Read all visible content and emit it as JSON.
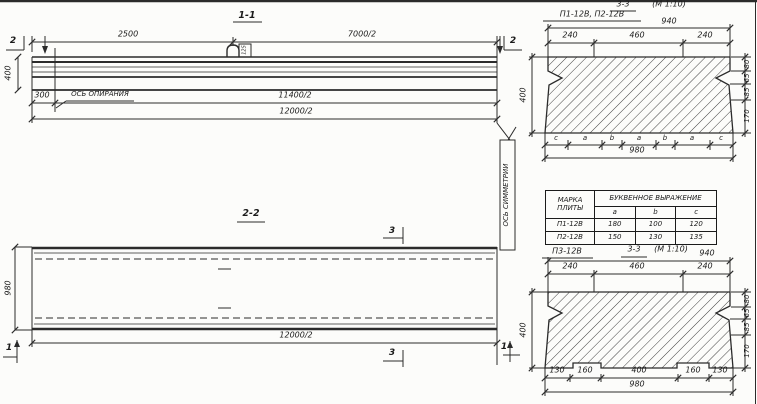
{
  "section11": {
    "title": "1-1",
    "dim_2500": "2500",
    "dim_7000": "7000/2",
    "cut_left": "2",
    "cut_right": "2",
    "dim_height": "400",
    "dim_300": "300",
    "support_axis_label": "ОСЬ ОПИРАНИЯ",
    "dim_11400": "11400/2",
    "dim_12000": "12000/2",
    "loop_mark": "125"
  },
  "section22": {
    "title": "2-2",
    "cut_3_top": "3",
    "cut_3_bottom": "3",
    "cut_1_left": "1",
    "cut_1_right": "1",
    "dim_width": "980",
    "dim_length": "12000/2",
    "symmetry_axis_label": "ОСЬ СИММЕТРИИ"
  },
  "sec33top": {
    "title": "3-3",
    "scale": "(М 1:10)",
    "marks": "П1-12В, П2-12В",
    "dim_top_total": "940",
    "top_dims": [
      "240",
      "460",
      "240"
    ],
    "dim_height": "400",
    "right_dims": [
      "80",
      "65",
      "85",
      "170"
    ],
    "letters": [
      "c",
      "a",
      "b",
      "a",
      "b",
      "a",
      "c"
    ],
    "dim_bottom_total": "980"
  },
  "table": {
    "col_mark": "МАРКА ПЛИТЫ",
    "header_expr": "БУКВЕННОЕ ВЫРАЖЕНИЕ",
    "cols": [
      "a",
      "b",
      "c"
    ],
    "rows": [
      {
        "mark": "П1-12В",
        "a": "180",
        "b": "100",
        "c": "120"
      },
      {
        "mark": "П2-12В",
        "a": "150",
        "b": "130",
        "c": "135"
      }
    ]
  },
  "sec33bot": {
    "mark": "П3-12В",
    "title": "3-3",
    "scale": "(М 1:10)",
    "dim_top_total": "940",
    "top_dims": [
      "240",
      "460",
      "240"
    ],
    "dim_height": "400",
    "right_dims": [
      "80",
      "65",
      "85",
      "170"
    ],
    "bottom_dims": [
      "130",
      "160",
      "400",
      "160",
      "130"
    ],
    "dim_bottom_total": "980"
  }
}
